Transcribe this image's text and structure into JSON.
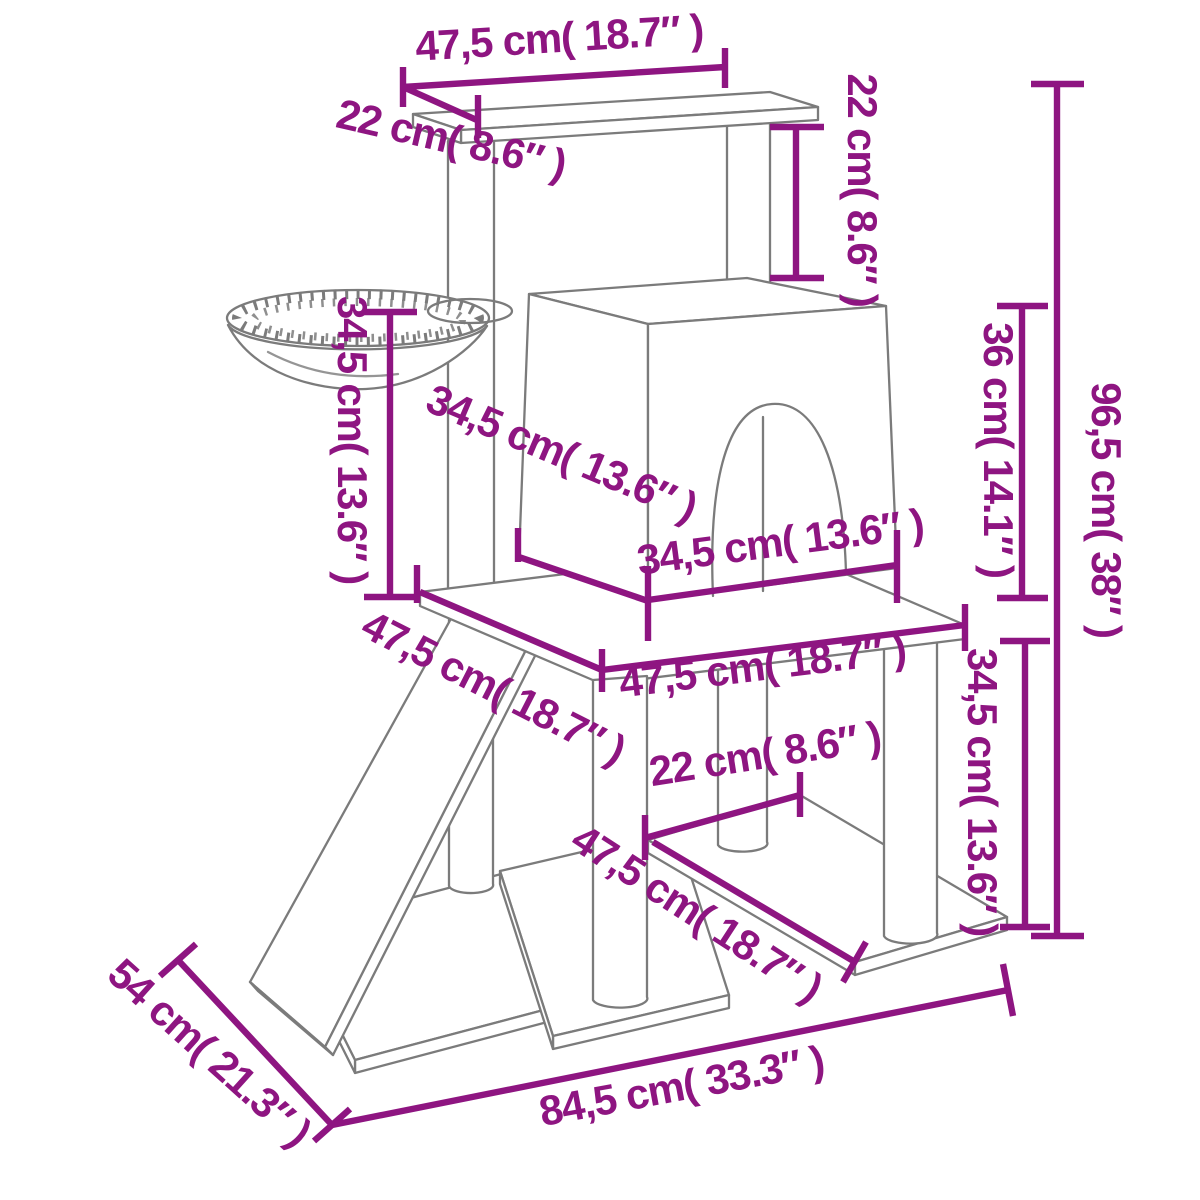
{
  "page": {
    "type": "product-dimension-diagram",
    "subject": "cat tree with scratching posts, hammock basket, condo with arched door, ramp, platforms and base",
    "colors": {
      "accent": "#8e1581",
      "outline": "#7b7b7b",
      "background": "#ffffff"
    }
  },
  "diagram": {
    "units": [
      "cm",
      "inch"
    ],
    "labels": {
      "top_platform_width": {
        "text": "47,5 cm( 18.7″ )",
        "cm": 47.5,
        "inch": 18.7
      },
      "top_platform_depth": {
        "text": "22 cm( 8.6″ )",
        "cm": 22,
        "inch": 8.6
      },
      "top_post_height": {
        "text": "22 cm( 8.6″ )",
        "cm": 22,
        "inch": 8.6
      },
      "total_height": {
        "text": "96,5 cm( 38″ )",
        "cm": 96.5,
        "inch": 38
      },
      "condo_height": {
        "text": "36 cm( 14.1″ )",
        "cm": 36,
        "inch": 14.1
      },
      "basket_post_height": {
        "text": "34,5 cm( 13.6″ )",
        "cm": 34.5,
        "inch": 13.6
      },
      "condo_depth": {
        "text": "34,5 cm( 13.6″ )",
        "cm": 34.5,
        "inch": 13.6
      },
      "condo_width": {
        "text": "34,5 cm( 13.6″ )",
        "cm": 34.5,
        "inch": 13.6
      },
      "platform_depth": {
        "text": "47,5 cm( 18.7″ )",
        "cm": 47.5,
        "inch": 18.7
      },
      "platform_width": {
        "text": "47,5 cm( 18.7″ )",
        "cm": 47.5,
        "inch": 18.7
      },
      "lower_level_height": {
        "text": "34,5 cm( 13.6″ )",
        "cm": 34.5,
        "inch": 13.6
      },
      "post_spacing": {
        "text": "22 cm( 8.6″ )",
        "cm": 22,
        "inch": 8.6
      },
      "shelf_depth": {
        "text": "47,5 cm( 18.7″ )",
        "cm": 47.5,
        "inch": 18.7
      },
      "base_depth": {
        "text": "54 cm( 21.3″ )",
        "cm": 54,
        "inch": 21.3
      },
      "base_width": {
        "text": "84,5 cm( 33.3″ )",
        "cm": 84.5,
        "inch": 33.3
      }
    }
  }
}
